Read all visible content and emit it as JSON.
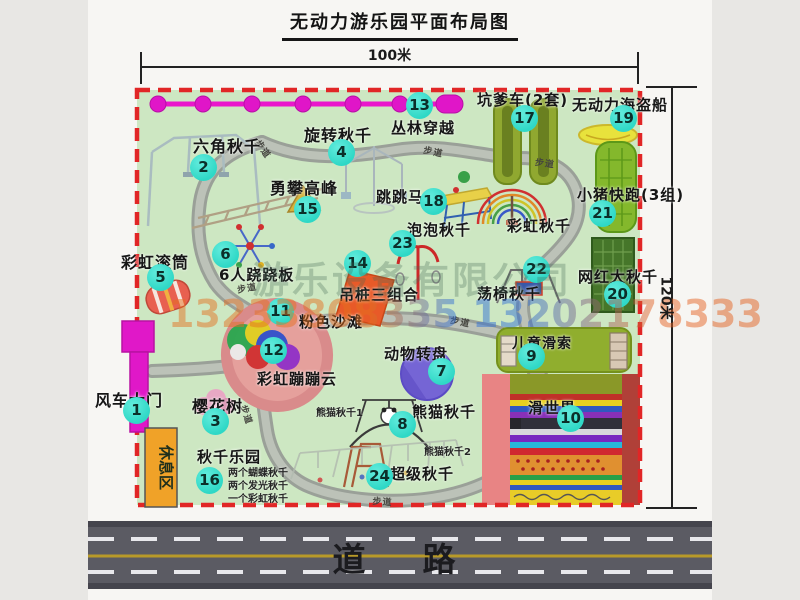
{
  "title": "无动力游乐园平面布局图",
  "dimensions": {
    "width": "100米",
    "height": "120米"
  },
  "road": {
    "label": "道　路"
  },
  "rest_area": {
    "label": "休息区"
  },
  "watermark": {
    "company": "游乐设备有限公司",
    "phone": "13233808335 13202178333"
  },
  "path_label": "步道",
  "colors": {
    "park_green": "#cde7c2",
    "border_red": "#e12626",
    "badge_teal": "#2fd8c6",
    "gate_magenta": "#e018c8",
    "rest_orange": "#f0a228",
    "road_gray": "#5b5b63",
    "zipline_magenta": "#e016c8",
    "beach_pink": "#d98b8b",
    "wheel_purple": "#7565d5"
  },
  "attractions": [
    {
      "num": "1",
      "name": "风车大门",
      "badge": [
        136,
        410
      ],
      "label": [
        95,
        387
      ],
      "fs": 16
    },
    {
      "num": "2",
      "name": "六角秋千",
      "badge": [
        203,
        167
      ],
      "label": [
        193,
        133
      ],
      "fs": 16
    },
    {
      "num": "3",
      "name": "樱花树",
      "badge": [
        215,
        421
      ],
      "label": [
        192,
        393
      ],
      "fs": 16
    },
    {
      "num": "4",
      "name": "旋转秋千",
      "badge": [
        341,
        152
      ],
      "label": [
        304,
        122
      ],
      "fs": 16
    },
    {
      "num": "5",
      "name": "彩虹滚筒",
      "badge": [
        160,
        277
      ],
      "label": [
        121,
        249
      ],
      "fs": 16
    },
    {
      "num": "6",
      "name": "6人跷跷板",
      "badge": [
        225,
        254
      ],
      "label": [
        219,
        264
      ],
      "fs": 15
    },
    {
      "num": "7",
      "name": "动物转盘",
      "badge": [
        441,
        371
      ],
      "label": [
        384,
        343
      ],
      "fs": 15
    },
    {
      "num": "8",
      "name": "熊猫秋千",
      "badge": [
        402,
        424
      ],
      "label": [
        412,
        401
      ],
      "fs": 15
    },
    {
      "num": "9",
      "name": "儿童滑索",
      "badge": [
        531,
        356
      ],
      "label": [
        512,
        333
      ],
      "fs": 14
    },
    {
      "num": "10",
      "name": "滑世界",
      "badge": [
        570,
        418
      ],
      "label": [
        528,
        397
      ],
      "fs": 15
    },
    {
      "num": "11",
      "name": "粉色沙滩",
      "badge": [
        280,
        311
      ],
      "label": [
        299,
        311
      ],
      "fs": 15
    },
    {
      "num": "12",
      "name": "彩虹蹦蹦云",
      "badge": [
        273,
        350
      ],
      "label": [
        257,
        368
      ],
      "fs": 15
    },
    {
      "num": "13",
      "name": "丛林穿越",
      "badge": [
        419,
        105
      ],
      "label": [
        391,
        117
      ],
      "fs": 15
    },
    {
      "num": "14",
      "name": "吊桩三组合",
      "badge": [
        357,
        263
      ],
      "label": [
        339,
        284
      ],
      "fs": 15
    },
    {
      "num": "15",
      "name": "勇攀高峰",
      "badge": [
        307,
        209
      ],
      "label": [
        270,
        175
      ],
      "fs": 16
    },
    {
      "num": "16",
      "name": "秋千乐园",
      "badge": [
        209,
        480
      ],
      "label": [
        197,
        446
      ],
      "fs": 15
    },
    {
      "num": "17",
      "name": "坑爹车(2套)",
      "badge": [
        524,
        118
      ],
      "label": [
        477,
        89
      ],
      "fs": 15
    },
    {
      "num": "18",
      "name": "跳跳马",
      "badge": [
        433,
        201
      ],
      "label": [
        376,
        186
      ],
      "fs": 15
    },
    {
      "num": "19",
      "name": "无动力海盗船",
      "badge": [
        623,
        118
      ],
      "label": [
        572,
        94
      ],
      "fs": 15
    },
    {
      "num": "20",
      "name": "网红大秋千",
      "badge": [
        617,
        294
      ],
      "label": [
        578,
        266
      ],
      "fs": 15
    },
    {
      "num": "21",
      "name": "小猪快跑(3组)",
      "badge": [
        602,
        213
      ],
      "label": [
        577,
        184
      ],
      "fs": 15
    },
    {
      "num": "22",
      "name": "荡椅秋千",
      "badge": [
        536,
        269
      ],
      "label": [
        477,
        283
      ],
      "fs": 15
    },
    {
      "num": "23",
      "name": "泡泡秋千",
      "badge": [
        402,
        243
      ],
      "label": [
        407,
        219
      ],
      "fs": 15
    },
    {
      "num": "24",
      "name": "超级秋千",
      "badge": [
        379,
        476
      ],
      "label": [
        390,
        463
      ],
      "fs": 15
    },
    {
      "num": null,
      "name": "彩虹秋千",
      "badge": null,
      "label": [
        507,
        215
      ],
      "fs": 15
    }
  ],
  "small_labels": [
    {
      "text": "熊猫秋千1",
      "pos": [
        316,
        404
      ],
      "fs": 10
    },
    {
      "text": "熊猫秋千2",
      "pos": [
        424,
        443
      ],
      "fs": 10
    },
    {
      "text": "两个蝴蝶秋千",
      "pos": [
        228,
        464
      ],
      "fs": 10
    },
    {
      "text": "两个发光秋千",
      "pos": [
        228,
        477
      ],
      "fs": 10
    },
    {
      "text": "一个彩虹秋千",
      "pos": [
        228,
        490
      ],
      "fs": 10
    }
  ],
  "walkway_labels": [
    {
      "pos": [
        263,
        137
      ],
      "rot": 55
    },
    {
      "pos": [
        425,
        143
      ],
      "rot": 12
    },
    {
      "pos": [
        536,
        155
      ],
      "rot": 8
    },
    {
      "pos": [
        236,
        283
      ],
      "rot": -10
    },
    {
      "pos": [
        452,
        313
      ],
      "rot": 12
    },
    {
      "pos": [
        250,
        403
      ],
      "rot": 72
    },
    {
      "pos": [
        373,
        494
      ],
      "rot": 4
    }
  ]
}
